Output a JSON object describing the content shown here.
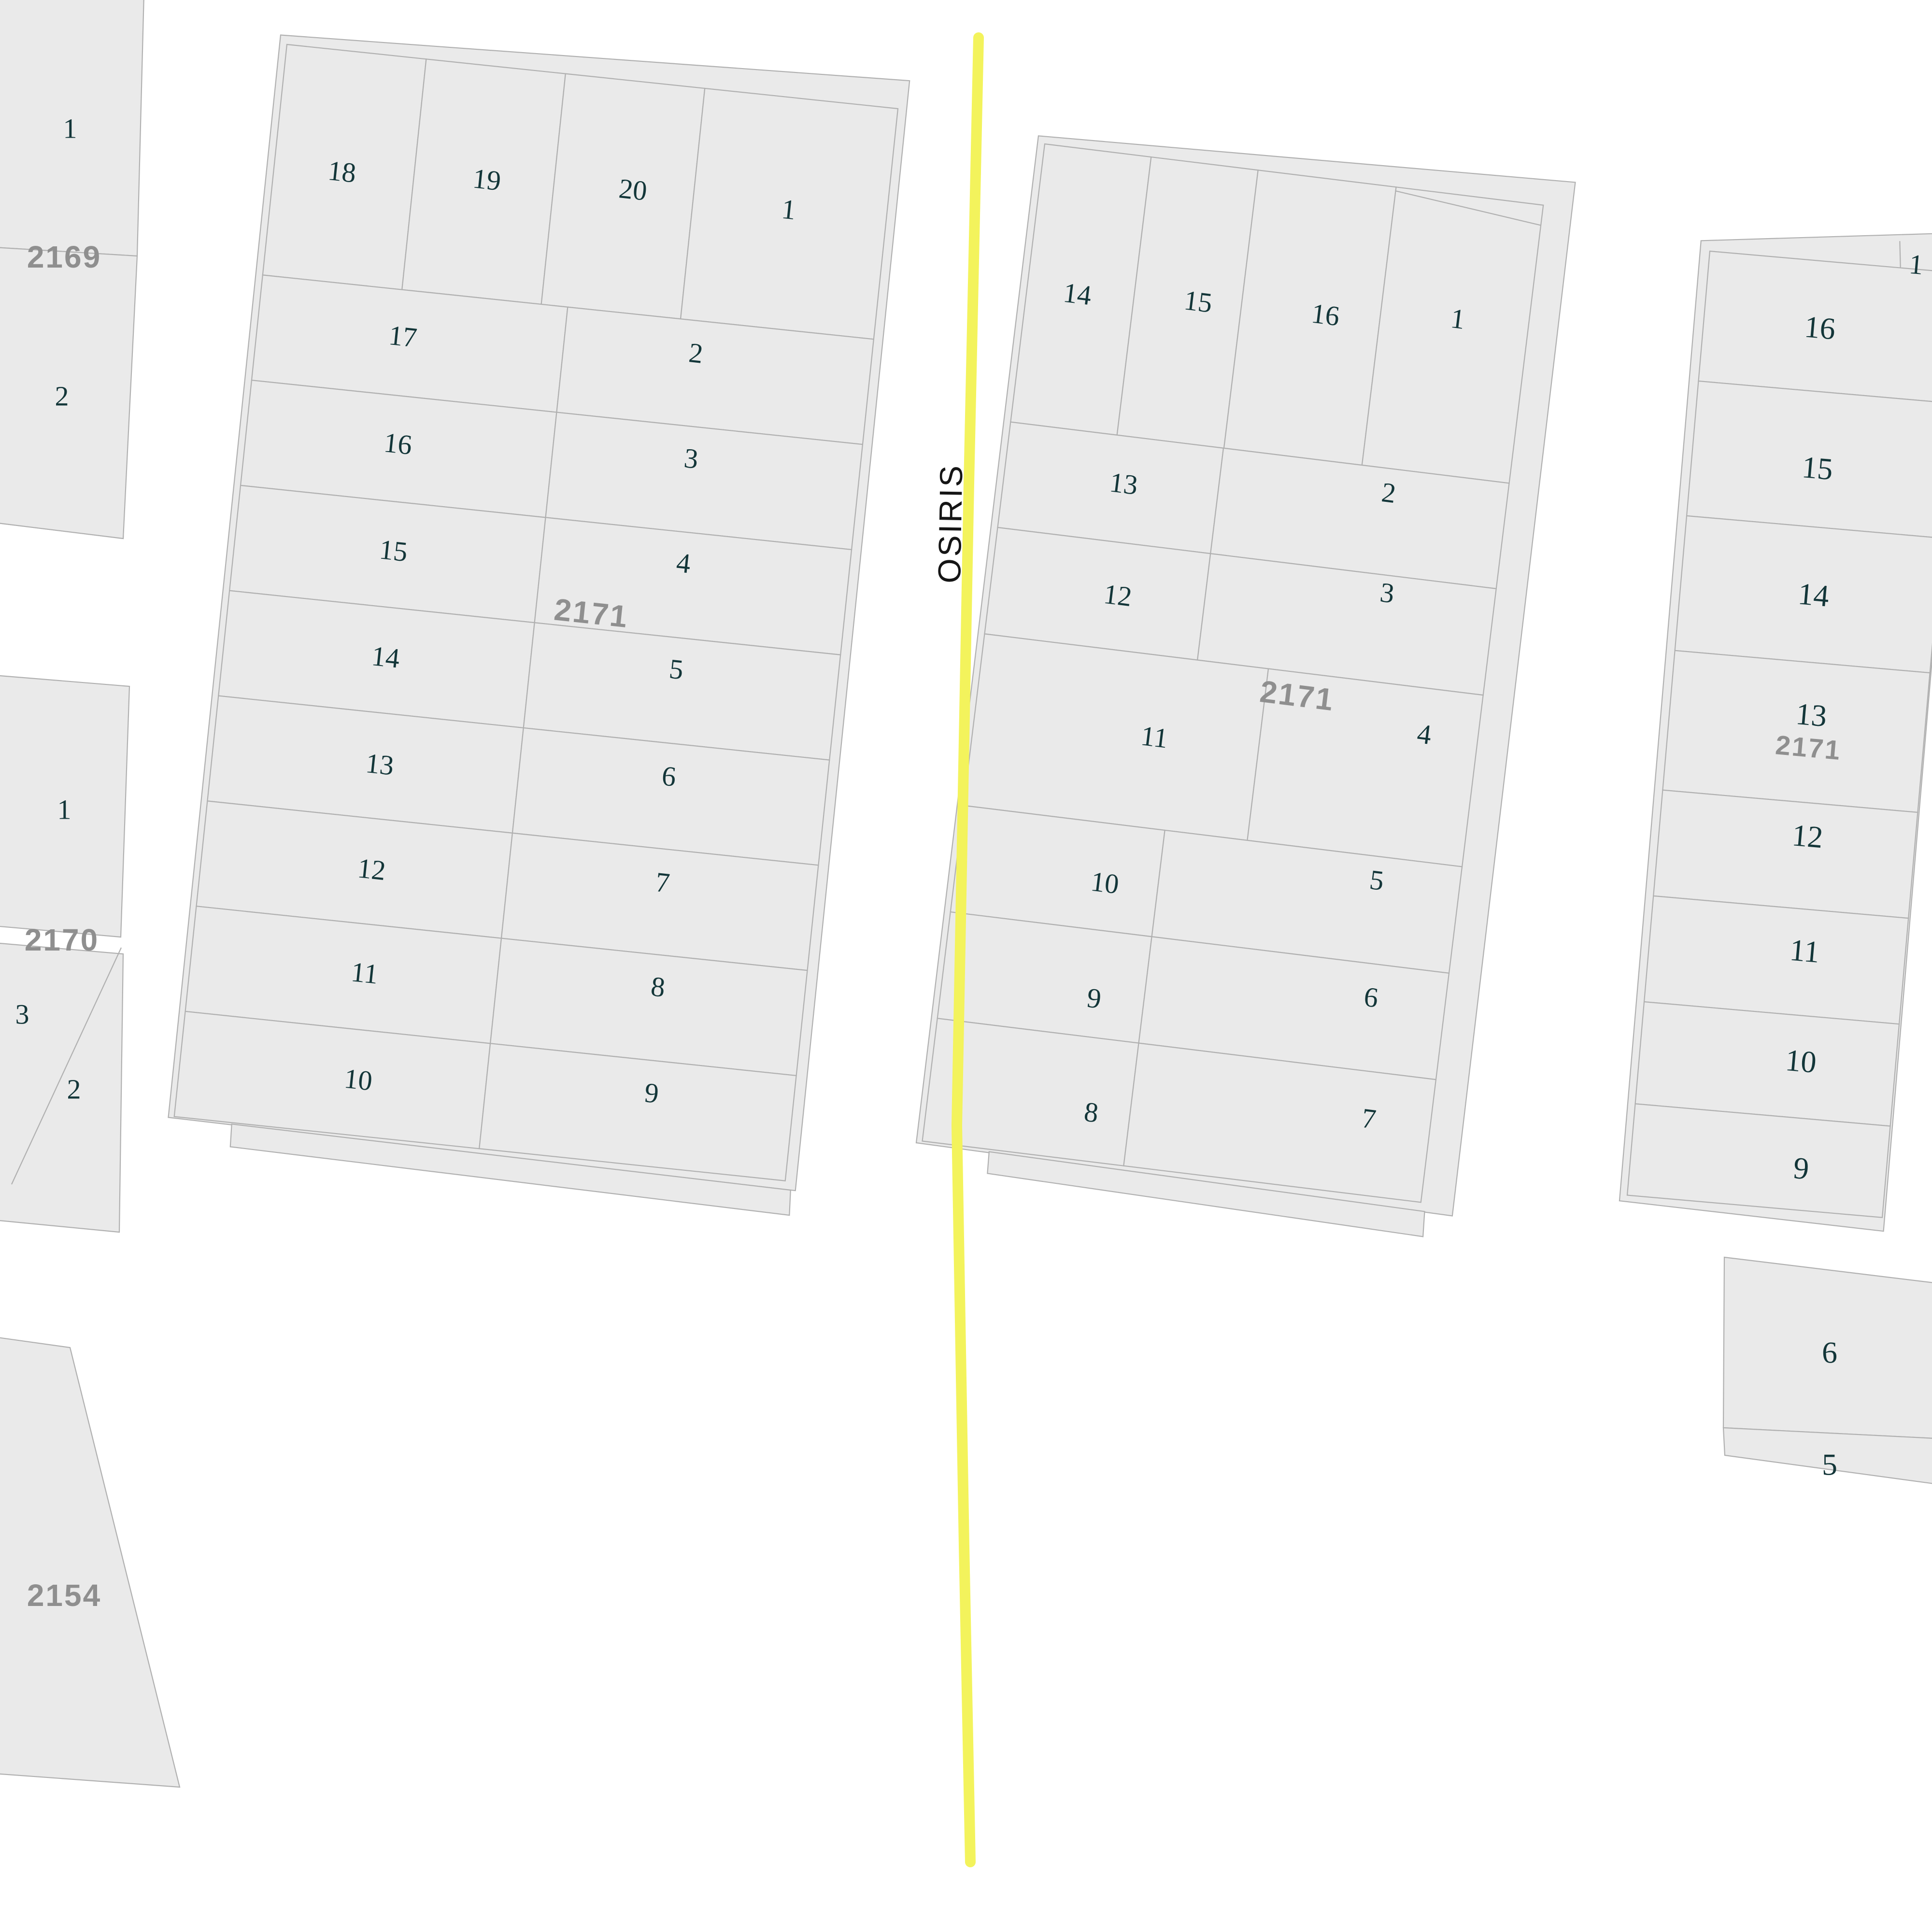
{
  "street": {
    "name": "OSIRIS"
  },
  "colors": {
    "background": "#ffffff",
    "parcel_fill": "#eaeaea",
    "parcel_stroke": "#b0b0b0",
    "lot_number_color": "#133639",
    "block_label_color": "#8f8f8f",
    "street_line_color": "#f3f35c",
    "street_label_color": "#151515"
  },
  "blocks": {
    "b2169": {
      "label": "2169",
      "lots": {
        "l1": "1",
        "l2": "2"
      }
    },
    "b2170": {
      "label": "2170",
      "lots": {
        "l1": "1",
        "l3": "3",
        "l2": "2"
      }
    },
    "b2171w": {
      "label": "2171",
      "lots": {
        "l18": "18",
        "l19": "19",
        "l20": "20",
        "l1": "1",
        "l17": "17",
        "l2": "2",
        "l16": "16",
        "l3": "3",
        "l15": "15",
        "l4": "4",
        "l14": "14",
        "l5": "5",
        "l13": "13",
        "l6": "6",
        "l12": "12",
        "l7": "7",
        "l11": "11",
        "l8": "8",
        "l10": "10",
        "l9": "9"
      }
    },
    "b2171e": {
      "label": "2171",
      "lots": {
        "l14": "14",
        "l15": "15",
        "l16": "16",
        "l1": "1",
        "l13": "13",
        "l2": "2",
        "l12": "12",
        "l3": "3",
        "l11": "11",
        "l4": "4",
        "l10": "10",
        "l5": "5",
        "l9": "9",
        "l6": "6",
        "l8": "8",
        "l7": "7"
      }
    },
    "b2171r": {
      "label": "2171",
      "lots": {
        "l16": "16",
        "l15": "15",
        "l14": "14",
        "l13": "13",
        "l12": "12",
        "l11": "11",
        "l10": "10",
        "l9": "9",
        "l1": "1"
      }
    },
    "bsoutheast": {
      "lots": {
        "l6": "6",
        "l5": "5"
      }
    },
    "b2154": {
      "label": "2154"
    }
  }
}
